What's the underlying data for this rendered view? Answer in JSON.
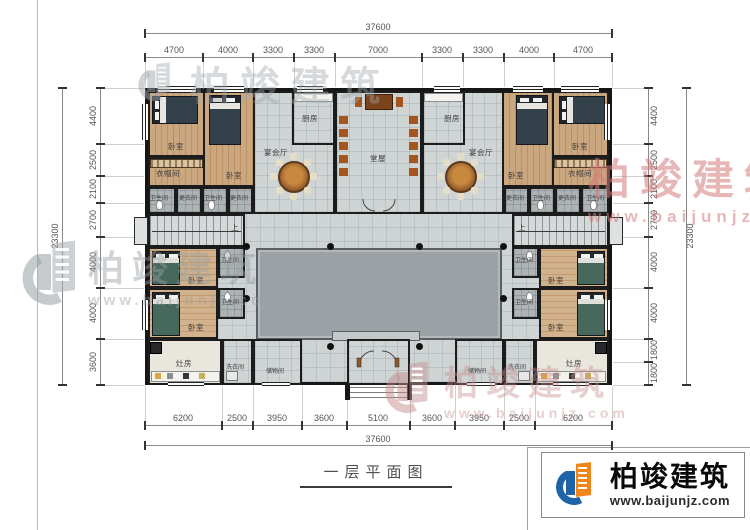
{
  "meta": {
    "title": "一层平面图"
  },
  "brand": {
    "name": "柏竣建筑",
    "url": "www.baijunjz.com"
  },
  "dims": {
    "top": {
      "total": "37600",
      "segments": [
        "4700",
        "4000",
        "3300",
        "3300",
        "7000",
        "3300",
        "3300",
        "4000",
        "4700"
      ]
    },
    "bottom": {
      "total": "37600",
      "segments": [
        "6200",
        "2500",
        "3950",
        "3600",
        "5100",
        "3600",
        "3950",
        "2500",
        "6200"
      ]
    },
    "left": {
      "total": "23300",
      "segments": [
        "4400",
        "2500",
        "2100",
        "2700",
        "4000",
        "4000",
        "3600"
      ]
    },
    "right": {
      "total": "23300",
      "segments": [
        "4400",
        "2500",
        "2100",
        "2700",
        "4000",
        "4000",
        "1800",
        "1800"
      ]
    }
  },
  "rooms": {
    "bedroom": "卧室",
    "cloakroom": "衣帽间",
    "banquet": "宴会厅",
    "kitchen": "厨房",
    "hall": "堂屋",
    "bath": "卫生间",
    "dressing": "更衣间",
    "stove": "灶房",
    "laundry": "洗衣间",
    "storage": "储物间",
    "up": "上"
  },
  "colors": {
    "wall": "#161616",
    "floor": "#ced3d4",
    "courtyard": "#9ba1a5",
    "wood": "#c9a47d",
    "brand_blue": "#1e63a8",
    "brand_orange": "#f08519",
    "watermark_pink": "#d98c8c"
  }
}
